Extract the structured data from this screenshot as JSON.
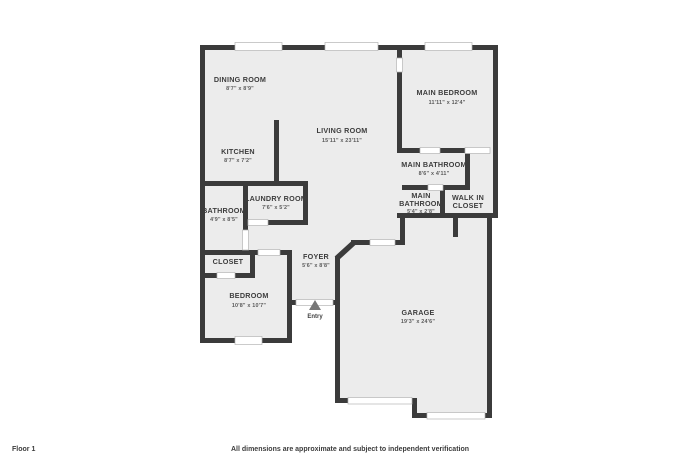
{
  "colors": {
    "wall": "#3b3b3b",
    "floor": "#ececec",
    "room_text": "#3d3d3d",
    "dims_text": "#5a5a5a"
  },
  "rooms": {
    "dining": {
      "name": "DINING ROOM",
      "dims": "8'7\" x 8'9\""
    },
    "kitchen": {
      "name": "KITCHEN",
      "dims": "8'7\" x 7'2\""
    },
    "living": {
      "name": "LIVING ROOM",
      "dims": "15'11\" x 23'11\""
    },
    "main_bedroom": {
      "name": "MAIN BEDROOM",
      "dims": "11'11\" x 12'4\""
    },
    "main_bathroom": {
      "name": "MAIN BATHROOM",
      "dims": "8'6\" x 4'11\""
    },
    "main_bathroom_2": {
      "name1": "MAIN",
      "name2": "BATHROOM",
      "dims": "5'4\" x 2'8\""
    },
    "walk_in_closet": {
      "name1": "WALK IN",
      "name2": "CLOSET"
    },
    "laundry": {
      "name": "LAUNDRY ROOM",
      "dims": "7'6\" x 5'2\""
    },
    "bathroom": {
      "name": "BATHROOM",
      "dims": "4'9\" x 8'5\""
    },
    "closet": {
      "name": "CLOSET"
    },
    "foyer": {
      "name": "FOYER",
      "dims": "5'6\" x 8'8\""
    },
    "bedroom": {
      "name": "BEDROOM",
      "dims": "10'8\" x 10'7\""
    },
    "garage": {
      "name": "GARAGE",
      "dims": "19'3\" x 24'6\""
    }
  },
  "entry": {
    "label": "Entry"
  },
  "footer": {
    "floor_label": "Floor 1",
    "disclaimer": "All dimensions are approximate and subject to independent verification"
  }
}
